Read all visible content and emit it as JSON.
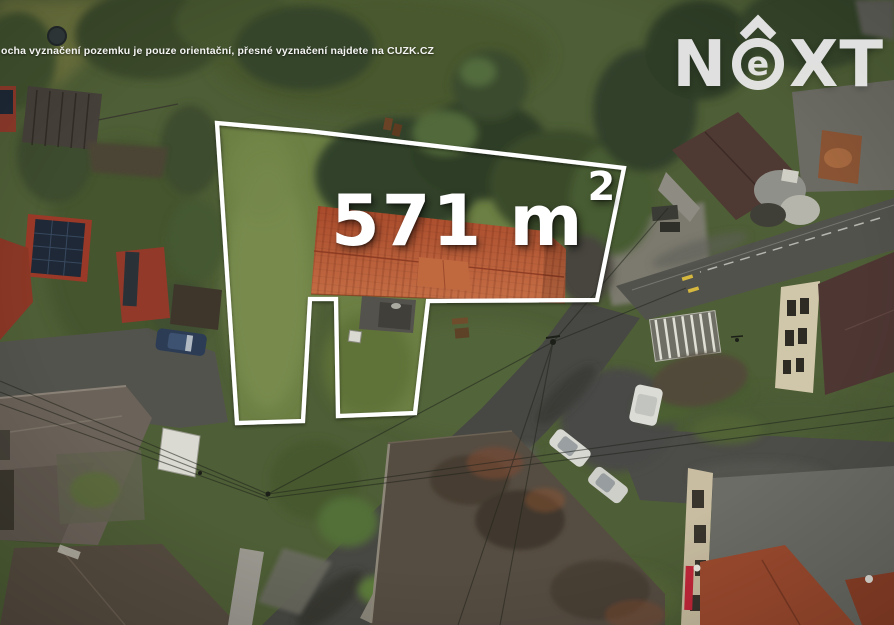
{
  "disclaimer": {
    "text": "ocha vyznačení pozemku je pouze orientační, přesné vyznačení najdete na CUZK.CZ"
  },
  "area_label": {
    "value": "571 m",
    "exponent": "2",
    "full_text": "571 m²"
  },
  "logo": {
    "name": "NEXT",
    "letter_n": "N",
    "letter_e": "e",
    "letter_x": "X",
    "letter_t": "T"
  },
  "parcel": {
    "polygon_points": "217,123 308,131 624,168 597,300 428,301 415,413 338,416 336,299 310,299 303,421 237,423"
  },
  "colors": {
    "boundary": "#ffffff",
    "text": "#ffffff",
    "logo": "#e9e9e9",
    "grass_base": "#4e5e36",
    "parcel_lawn": "#6c7f44",
    "house_roof_dark": "#a84a2b",
    "house_roof_light": "#c66f46",
    "road_asphalt": "#474743",
    "solar_panel": "#1e2836",
    "red_roof": "#9a3927"
  }
}
